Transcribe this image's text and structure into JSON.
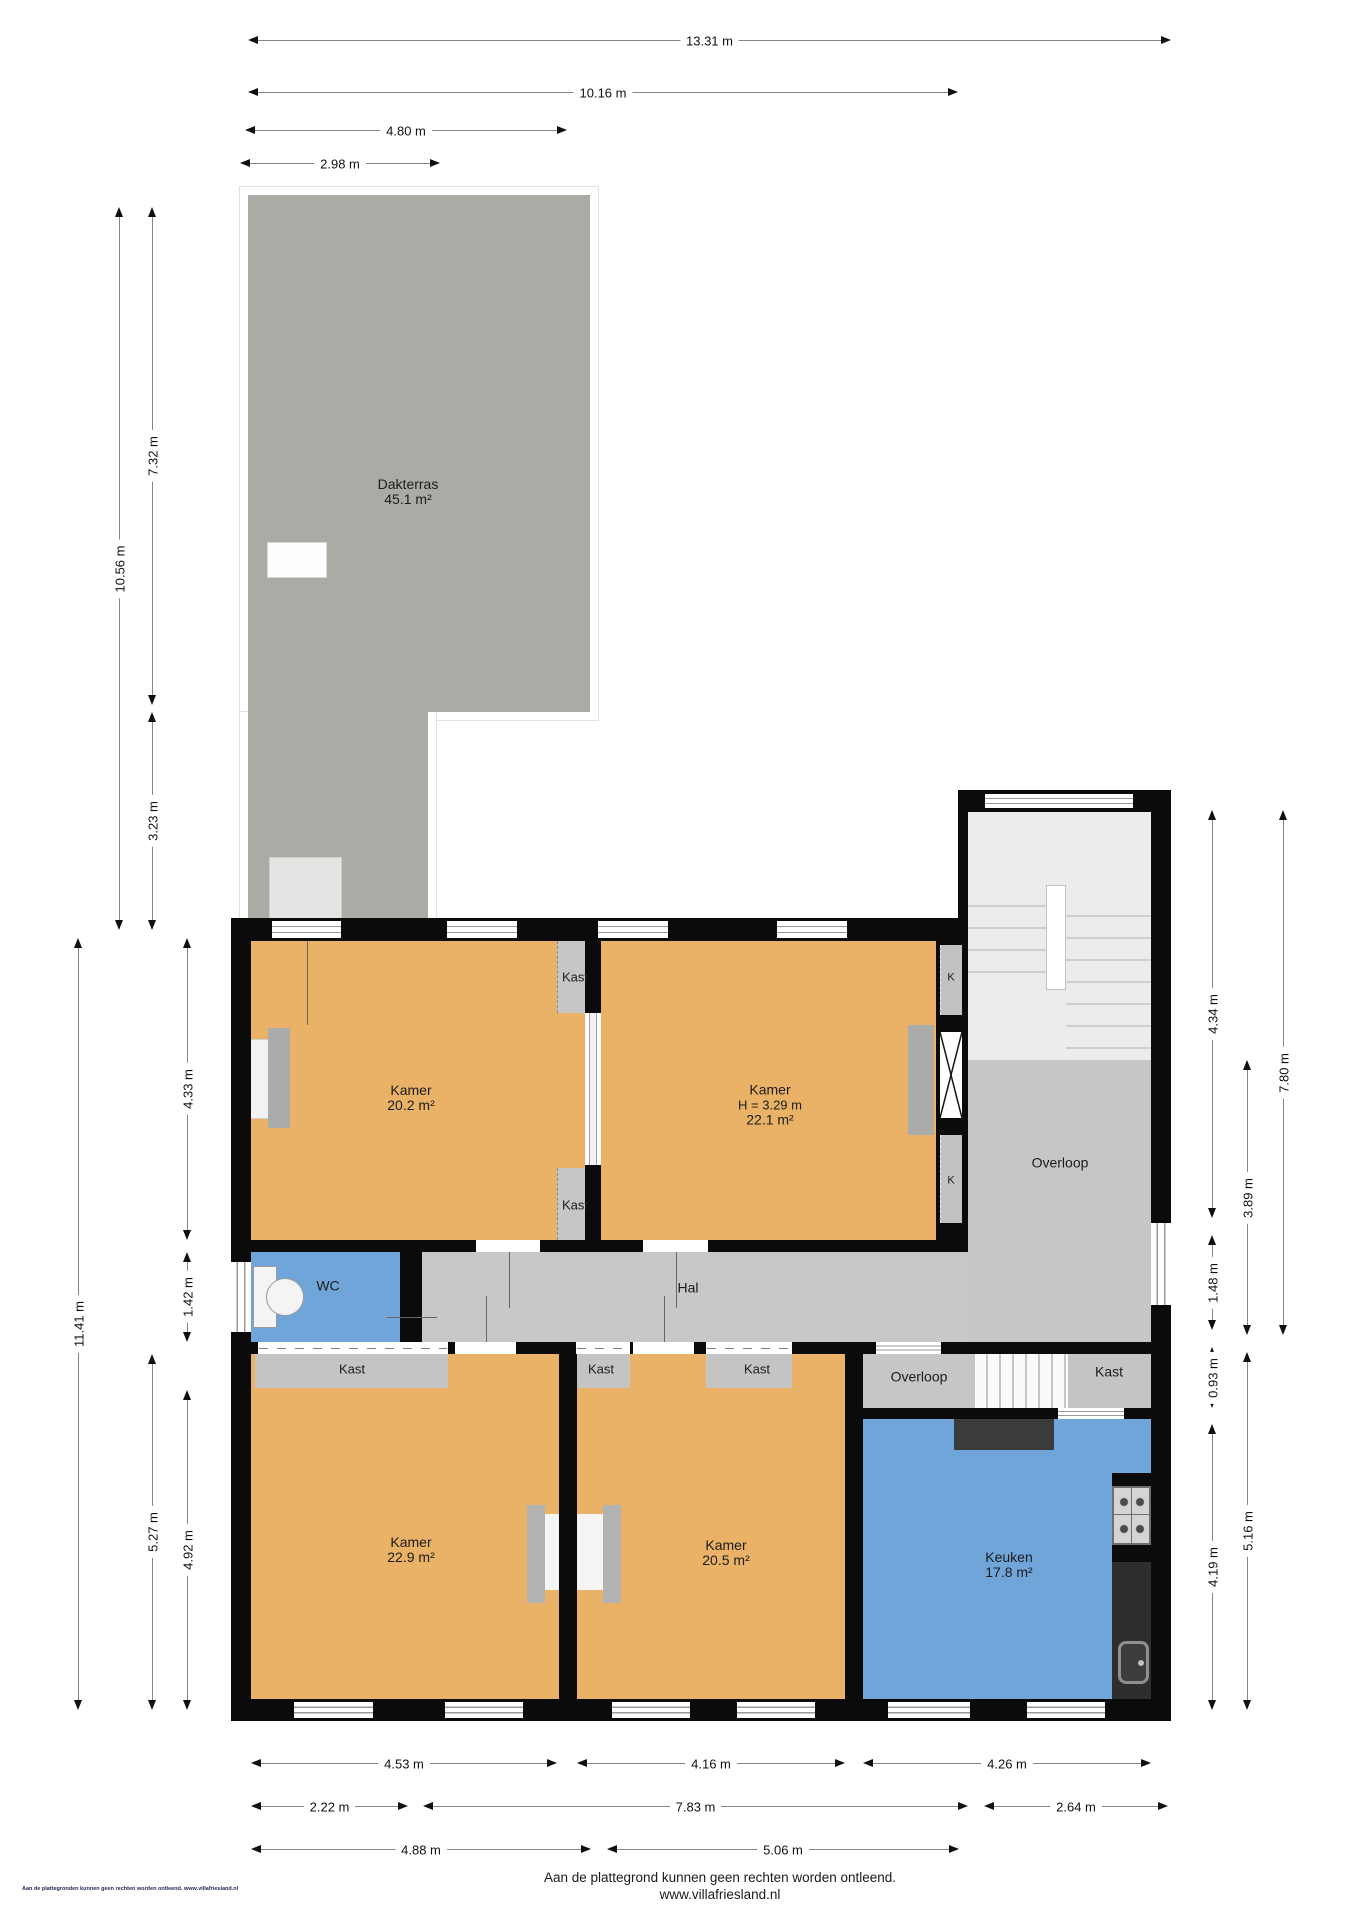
{
  "rooms": {
    "dakterras": {
      "name": "Dakterras",
      "area": "45.1 m²"
    },
    "kamer_tl": {
      "name": "Kamer",
      "area": "20.2 m²"
    },
    "kamer_tr": {
      "name": "Kamer",
      "height": "H = 3.29 m",
      "area": "22.1 m²"
    },
    "kamer_bl": {
      "name": "Kamer",
      "area": "22.9 m²"
    },
    "kamer_bm": {
      "name": "Kamer",
      "area": "20.5 m²"
    },
    "keuken": {
      "name": "Keuken",
      "area": "17.8 m²"
    },
    "wc": {
      "name": "WC"
    },
    "hal": {
      "name": "Hal"
    },
    "overloop_boven": {
      "name": "Overloop"
    },
    "overloop_beneden": {
      "name": "Overloop"
    }
  },
  "closets": {
    "kast": "Kast",
    "k": "K"
  },
  "dims": {
    "top": [
      "13.31 m",
      "10.16 m",
      "4.80 m",
      "2.98 m"
    ],
    "left": [
      "10.56 m",
      "7.32 m",
      "3.23 m",
      "11.41 m",
      "4.33 m",
      "1.42 m",
      "5.27 m",
      "4.92 m"
    ],
    "right": [
      "4.34 m",
      "7.80 m",
      "3.89 m",
      "1.48 m",
      "0.93 m",
      "5.16 m",
      "4.19 m"
    ],
    "bottom": [
      "4.53 m",
      "4.16 m",
      "4.26 m",
      "2.22 m",
      "7.83 m",
      "2.64 m",
      "4.88 m",
      "5.06 m"
    ]
  },
  "footer": {
    "line1": "Aan de plattegrond kunnen geen rechten worden ontleend.",
    "line2": "www.villafriesland.nl",
    "corner": "Aan de plattegronden kunnen geen rechten worden ontleend. www.villafriesland.nl"
  },
  "colors": {
    "room": "#E9B266",
    "wet": "#6FA5D8",
    "circulation": "#C8C8C8",
    "wall": "#0B0B0B",
    "terrace": "#ABABA6"
  }
}
